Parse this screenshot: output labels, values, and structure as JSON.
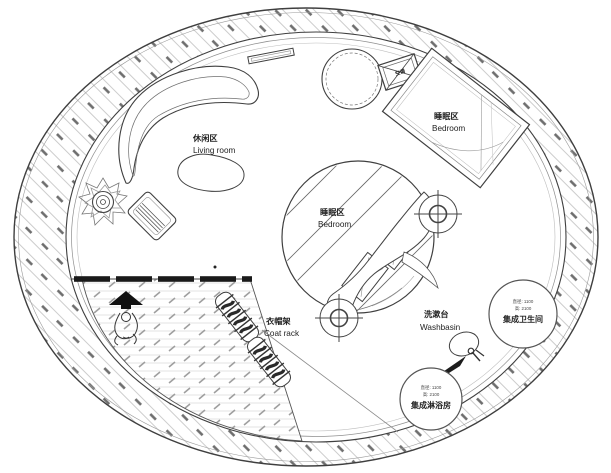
{
  "plan": {
    "labels": {
      "living": {
        "zh": "休闲区",
        "en": "Living room"
      },
      "bedroom_right": {
        "zh": "睡眠区",
        "en": "Bedroom"
      },
      "bedroom_center": {
        "zh": "睡眠区",
        "en": "Bedroom"
      },
      "coat_rack": {
        "zh": "衣帽架",
        "en": "Coat rack"
      },
      "washbasin": {
        "zh": "洗漱台",
        "en": "Washbasin"
      },
      "ac_unit": {
        "zh": "空调"
      },
      "bathroom_pod": {
        "spec1": "直径: 1100",
        "spec2": "高: 2100",
        "zh": "集成卫生间"
      },
      "shower_pod": {
        "spec1": "直径: 1100",
        "spec2": "高: 2100",
        "zh": "集成淋浴房"
      }
    },
    "colors": {
      "line": "#3f3f3f",
      "light_line": "#9a9a9a",
      "hatch_light": "#cccccc",
      "hatch_dark": "#6e6e6e",
      "solid_fill": "#111111",
      "background": "#ffffff"
    }
  }
}
